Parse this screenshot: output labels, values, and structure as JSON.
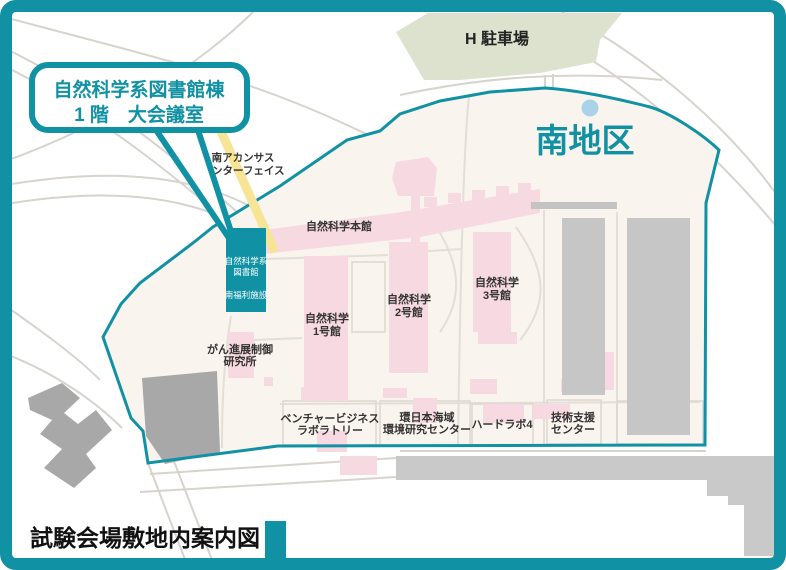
{
  "map_title": "試験会場敷地内案内図",
  "district_label": "南地区",
  "parking_label": "H 駐車場",
  "callout": {
    "line1": "自然科学系図書館棟",
    "line2": "1 階　大会議室"
  },
  "road_label": {
    "line1": "南アカンサス",
    "line2": "インターフェイス"
  },
  "highlight_building": {
    "name_line1": "自然科学系",
    "name_line2": "図書館",
    "name_line3": "南福利施設"
  },
  "buildings": {
    "honkan": "自然科学本館",
    "bldg1_l1": "自然科学",
    "bldg1_l2": "1号館",
    "bldg2_l1": "自然科学",
    "bldg2_l2": "2号館",
    "bldg3_l1": "自然科学",
    "bldg3_l2": "3号館",
    "cancer_l1": "がん進展制御",
    "cancer_l2": "研究所",
    "venture_l1": "ベンチャービジネス",
    "venture_l2": "ラボラトリー",
    "kannihonkai_l1": "環日本海域",
    "kannihonkai_l2": "環境研究センター",
    "hardlab": "ハードラボ4",
    "gijutsu_l1": "技術支援",
    "gijutsu_l2": "センター"
  },
  "colors": {
    "teal": "#1191a4",
    "pink": "#f7dae1",
    "cream": "#faf4ee",
    "green": "#dce2cd",
    "yellow": "#f8e495",
    "pond": "#abd3e8",
    "graybld": "#c6c6c6",
    "darkgray": "#a8a8a8",
    "roadband": "#c9c9c9",
    "roadline": "#d7d3cd",
    "insideline": "#e3ded8",
    "outlinebox": "#dcd7d1",
    "label": "#333333",
    "title": "#111111"
  }
}
